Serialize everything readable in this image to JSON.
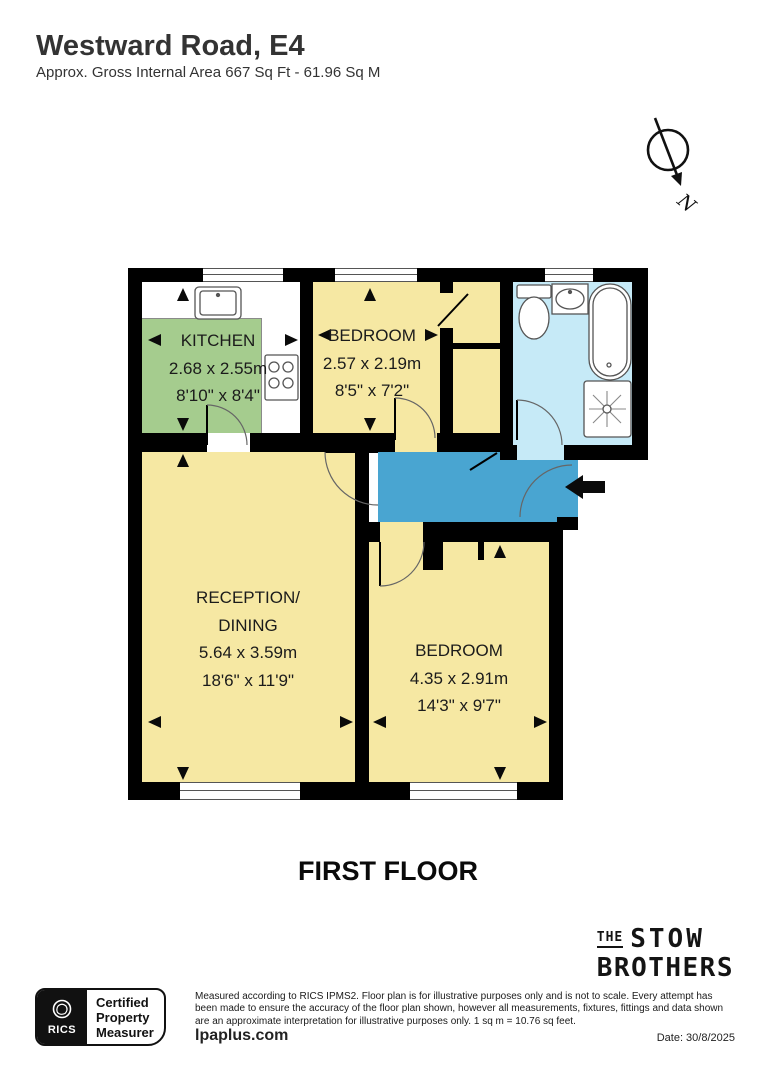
{
  "header": {
    "title": "Westward Road, E4",
    "subtitle": "Approx. Gross Internal Area 667 Sq Ft - 61.96 Sq M"
  },
  "compass": {
    "label": "N"
  },
  "floor": {
    "label": "FIRST FLOOR"
  },
  "rooms": {
    "kitchen": {
      "name": "KITCHEN",
      "metric": "2.68 x 2.55m",
      "imperial": "8'10\" x 8'4\""
    },
    "bedroom1": {
      "name": "BEDROOM",
      "metric": "2.57 x 2.19m",
      "imperial": "8'5\" x 7'2\""
    },
    "reception": {
      "name_line1": "RECEPTION/",
      "name_line2": "DINING",
      "metric": "5.64 x 3.59m",
      "imperial": "18'6\" x 11'9\""
    },
    "bedroom2": {
      "name": "BEDROOM",
      "metric": "4.35 x 2.91m",
      "imperial": "14'3\" x 9'7\""
    }
  },
  "branding": {
    "logo_the": "THE",
    "logo_stow": "STOW",
    "logo_brothers": "BROTHERS"
  },
  "certification": {
    "org": "RICS",
    "line1": "Certified",
    "line2": "Property",
    "line3": "Measurer"
  },
  "footer": {
    "disclaimer": "Measured according to RICS IPMS2. Floor plan is for illustrative purposes only and is not to scale. Every attempt has been made to ensure the accuracy of the floor plan shown, however all measurements, fixtures, fittings and data shown are an approximate interpretation for illustrative purposes only. 1 sq m = 10.76 sq feet.",
    "website": "lpaplus.com",
    "date": "Date: 30/8/2025"
  },
  "colors": {
    "room_yellow": "#f6e8a3",
    "kitchen_green": "#a5cc8e",
    "bathroom_blue": "#c6eaf7",
    "hallway_blue": "#49a5d1",
    "wall": "#000000"
  }
}
